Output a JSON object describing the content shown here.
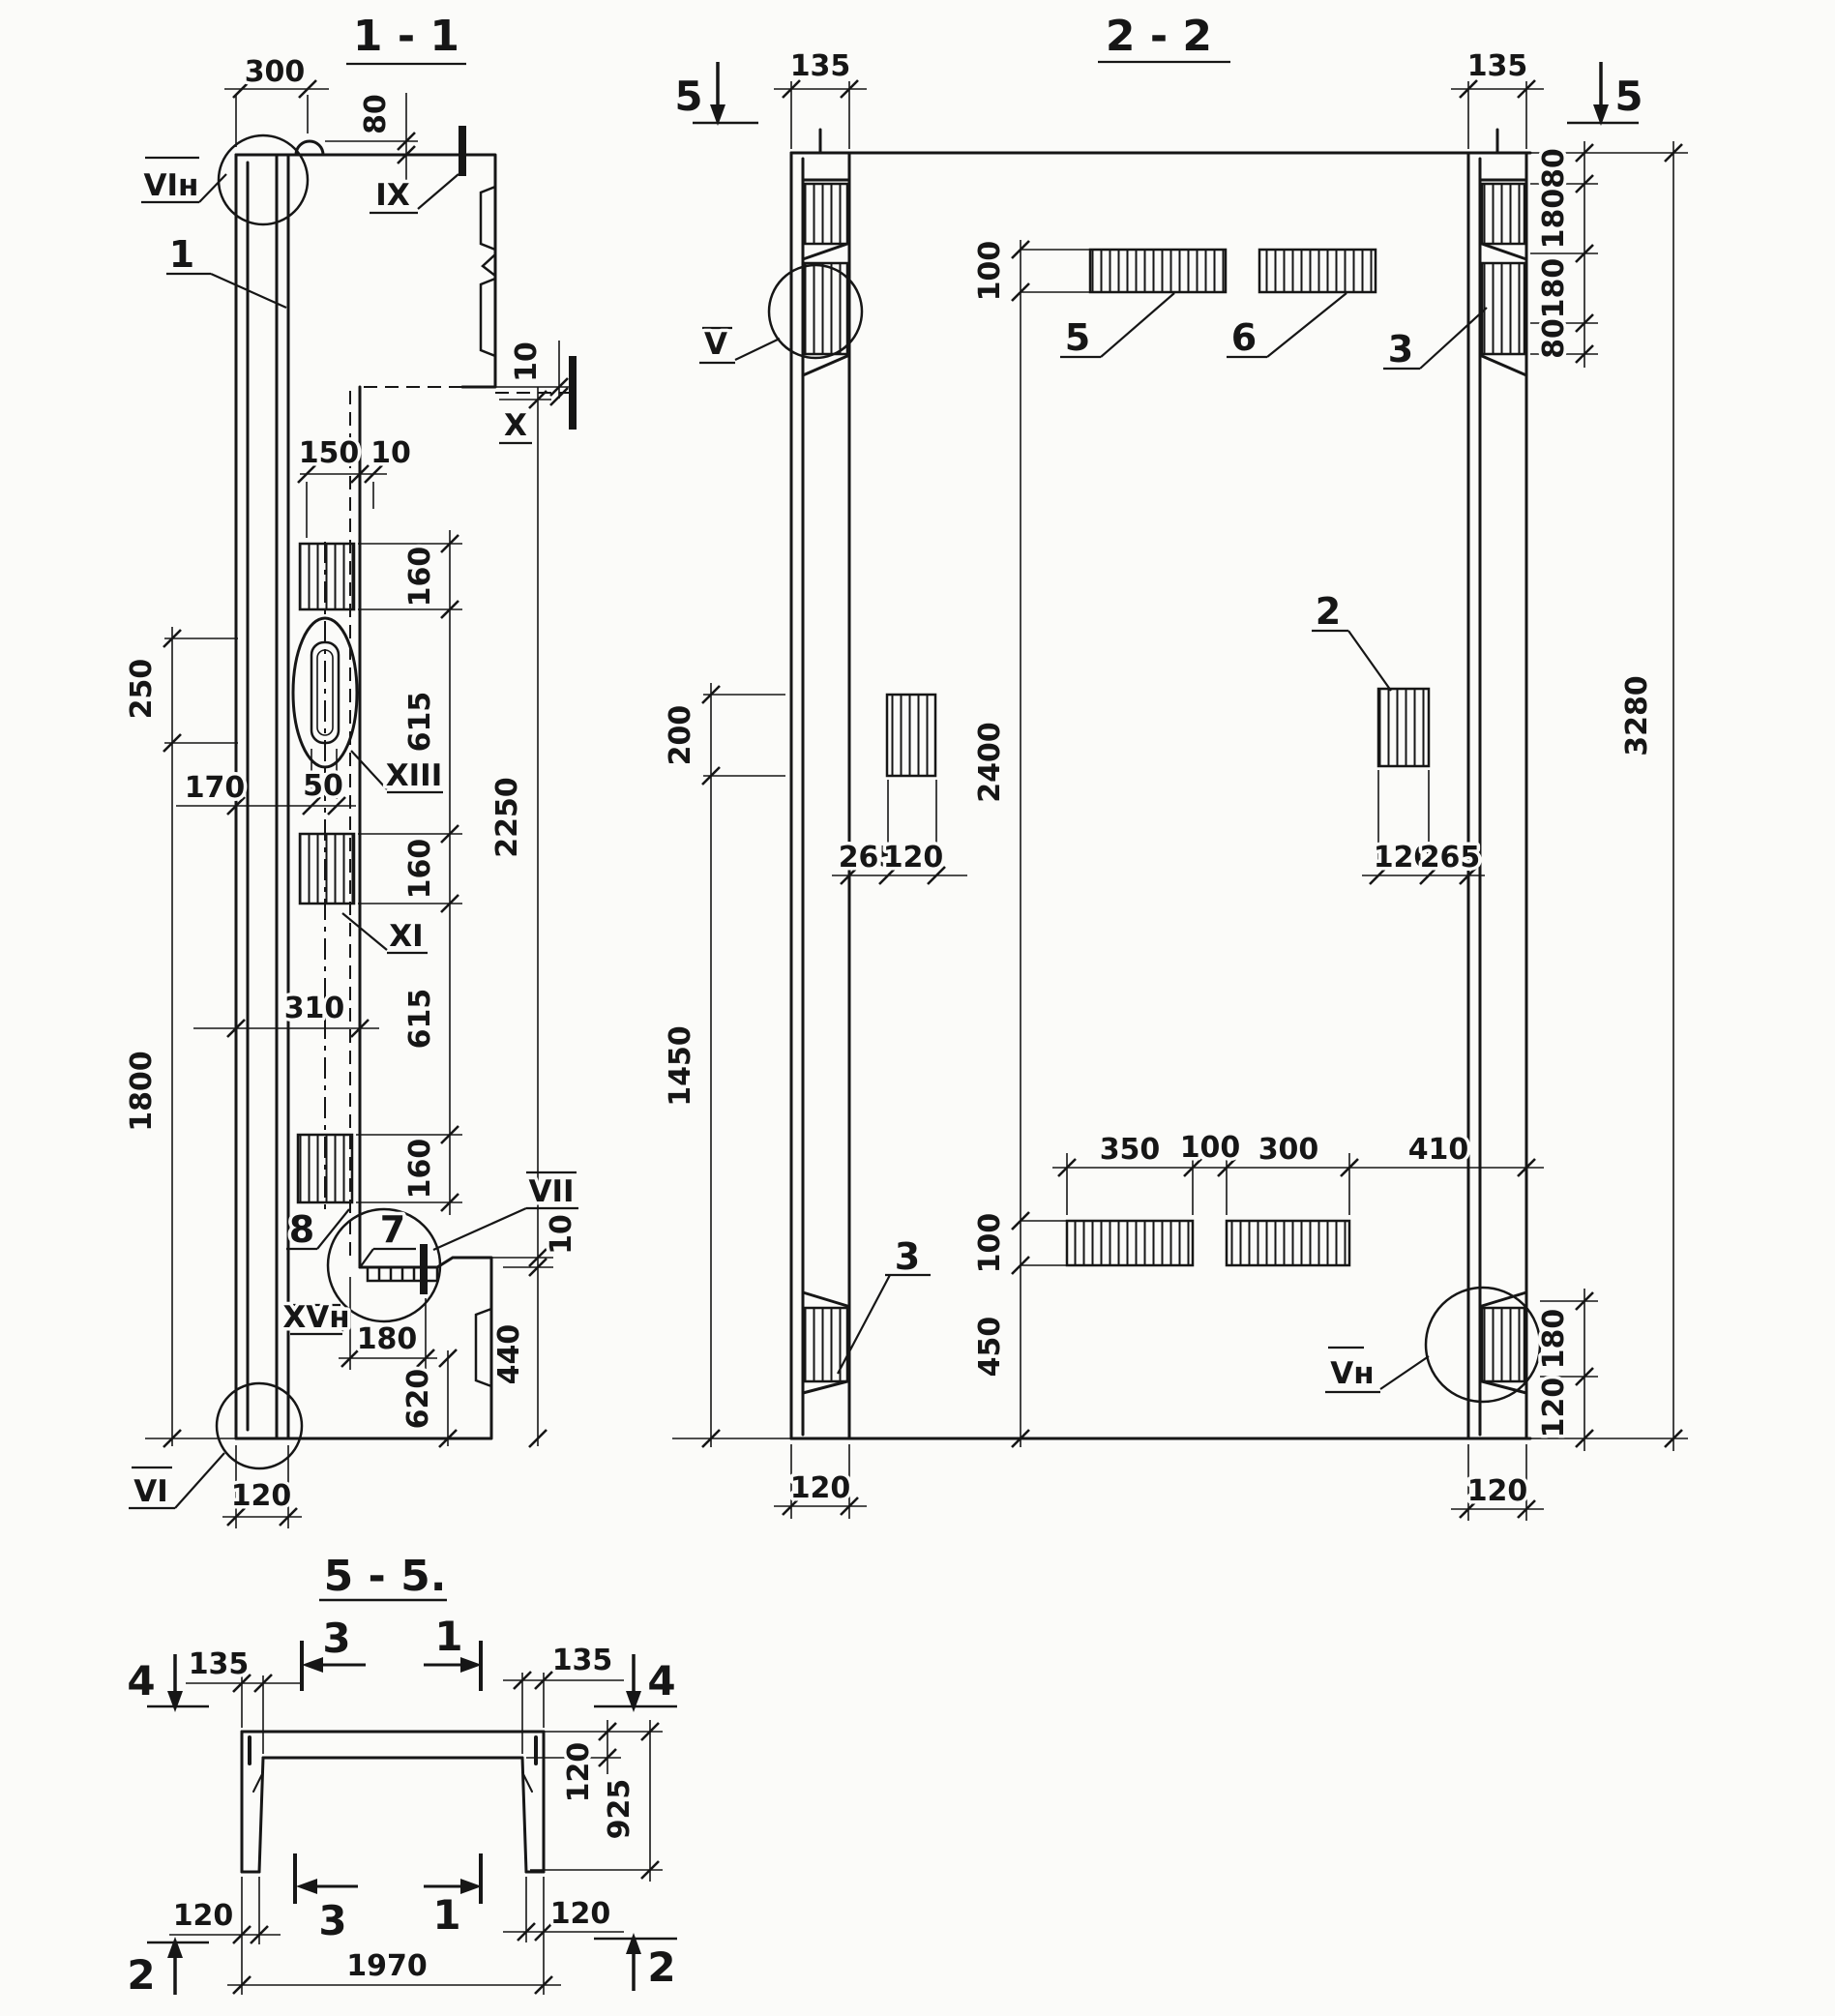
{
  "v11": {
    "title": "1 - 1",
    "d300": "300",
    "d80": "80",
    "d150": "150",
    "d10": "10",
    "d160": "160",
    "d615": "615",
    "d2250": "2250",
    "d250": "250",
    "d170": "170",
    "d50": "50",
    "d310": "310",
    "d1800": "1800",
    "d440": "440",
    "d180": "180",
    "d620": "620",
    "d120": "120",
    "mVIn": "VIн",
    "mIX": "IX",
    "mX": "X",
    "mXIII": "XIII",
    "mXI": "XI",
    "mVII": "VII",
    "mXVn": "XVн",
    "mVI": "VI",
    "p1": "1",
    "p7": "7",
    "p8": "8"
  },
  "v22": {
    "title": "2 - 2",
    "s5": "5",
    "d135": "135",
    "d100": "100",
    "d200": "200",
    "d1450": "1450",
    "d2400": "2400",
    "d3280": "3280",
    "d265": "265",
    "d120": "120",
    "d80": "80",
    "d180": "180",
    "d350": "350",
    "d300": "300",
    "d410": "410",
    "d450": "450",
    "mV": "V",
    "mVn": "Vн",
    "p2": "2",
    "p3": "3",
    "p5": "5",
    "p6": "6"
  },
  "v55": {
    "title": "5 - 5.",
    "s4": "4",
    "s2": "2",
    "s3": "3",
    "s1": "1",
    "d135": "135",
    "d120": "120",
    "d925": "925",
    "d1970": "1970"
  }
}
